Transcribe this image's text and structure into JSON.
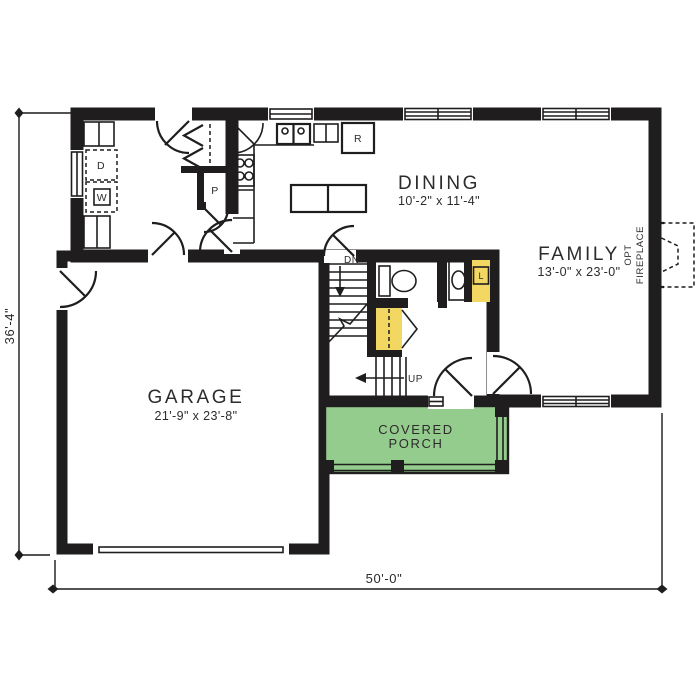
{
  "plan": {
    "rooms": {
      "dining": {
        "name": "DINING",
        "dims": "10'-2\" x 11'-4\""
      },
      "family": {
        "name": "FAMILY",
        "dims": "13'-0\" x 23'-0\""
      },
      "garage": {
        "name": "GARAGE",
        "dims": "21'-9\" x 23'-8\""
      },
      "porch": {
        "line1": "COVERED",
        "line2": "PORCH"
      }
    },
    "fixtures": {
      "dryer": "D",
      "washer": "W",
      "pantry": "P",
      "refrigerator": "R",
      "linen": "L"
    },
    "stairs": {
      "down": "DN",
      "up": "UP"
    },
    "fireplace": {
      "line1": "OPT",
      "line2": "FIREPLACE"
    },
    "dimensions": {
      "overall_width": "50'-0\"",
      "overall_depth": "36'-4\""
    },
    "colors": {
      "room_yellow": "#F2D763",
      "room_blue": "#9FC0E2",
      "porch_green": "#94CC8D",
      "wall_black": "#1f1d1e",
      "background": "#ffffff"
    }
  }
}
